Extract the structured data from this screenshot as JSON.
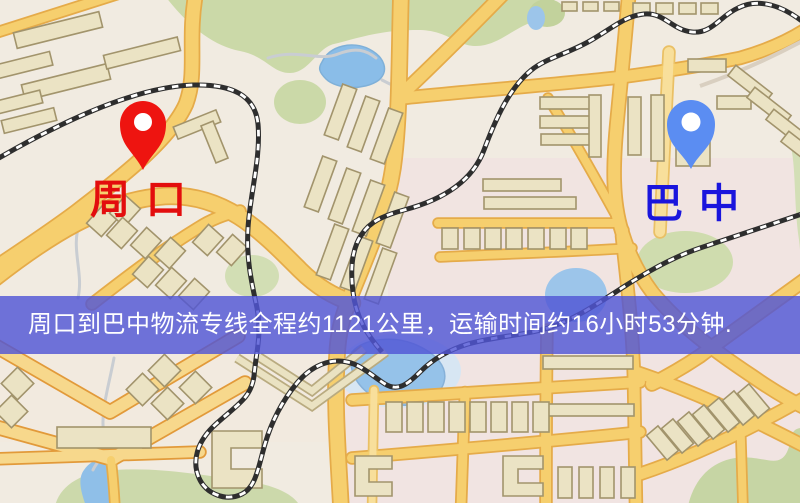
{
  "banner": {
    "text": "周口到巴中物流专线全程约1121公里，运输时间约16小时53分钟.",
    "background_color": "#5155d6",
    "text_color": "#ffffff"
  },
  "markers": {
    "origin": {
      "label": "周口",
      "pin_color": "#ee1410",
      "label_color": "#e30d0d"
    },
    "destination": {
      "label": "巴中",
      "pin_color": "#5b8df2",
      "label_color": "#1a15dd"
    }
  },
  "map_colors": {
    "background": "#f1ebe1",
    "road_fill": "#f6cf6e",
    "road_casing": "#e5ab49",
    "park": "#ccdaa9",
    "water": "#8fbfe8",
    "building": "#ebe3c4",
    "railway": "#2e2e2e"
  }
}
